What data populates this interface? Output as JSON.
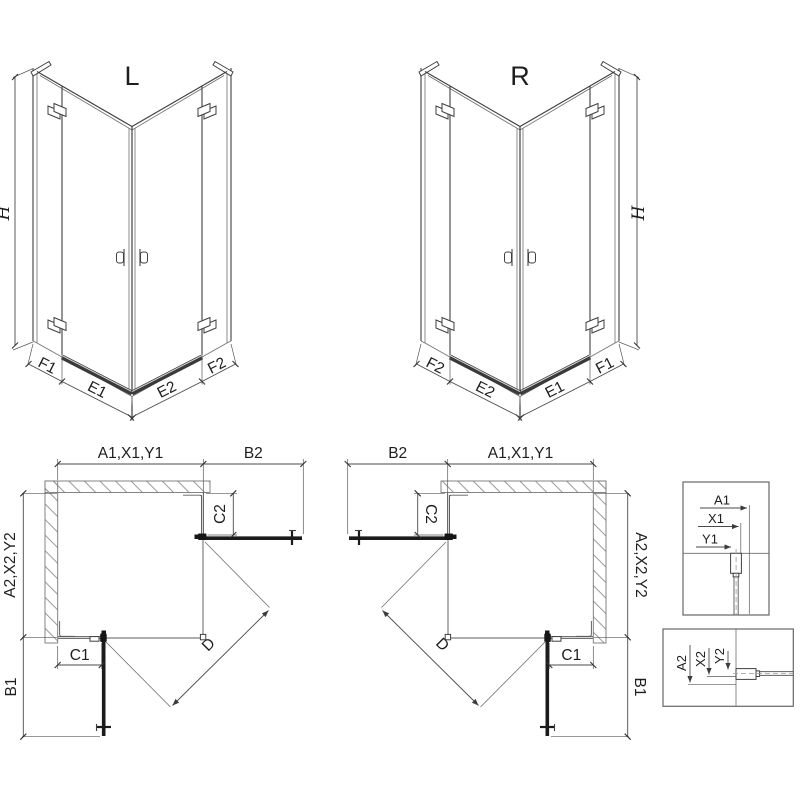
{
  "diagram": {
    "iso_left": {
      "title": "L",
      "height_label": "H",
      "bottom_labels": [
        "F1",
        "E1",
        "E2",
        "F2"
      ]
    },
    "iso_right": {
      "title": "R",
      "height_label": "H",
      "bottom_labels": [
        "F2",
        "E2",
        "E1",
        "F1"
      ]
    },
    "plan_left": {
      "width_top": "A1,X1,Y1",
      "door_top": "B2",
      "fixed_right": "C2",
      "depth_side": "A2,X2,Y2",
      "door_side": "B1",
      "fixed_bottom": "C1",
      "diagonal": "D"
    },
    "plan_right": {
      "width_top": "A1,X1,Y1",
      "door_top": "B2",
      "fixed_left": "C2",
      "depth_side": "A2,X2,Y2",
      "door_side": "B1",
      "fixed_bottom": "C1",
      "diagonal": "D"
    },
    "detail_vertical_profile": {
      "dims": [
        "A1",
        "X1",
        "Y1"
      ]
    },
    "detail_horizontal_profile": {
      "dims": [
        "A2",
        "X2",
        "Y2"
      ]
    }
  },
  "colors": {
    "background": "#ffffff",
    "line": "#3f3f3f",
    "dark": "#1b1b1b",
    "dim_lines": "#4a4a4a",
    "hatch": "#9a9a9a",
    "text": "#1e1e1e"
  }
}
